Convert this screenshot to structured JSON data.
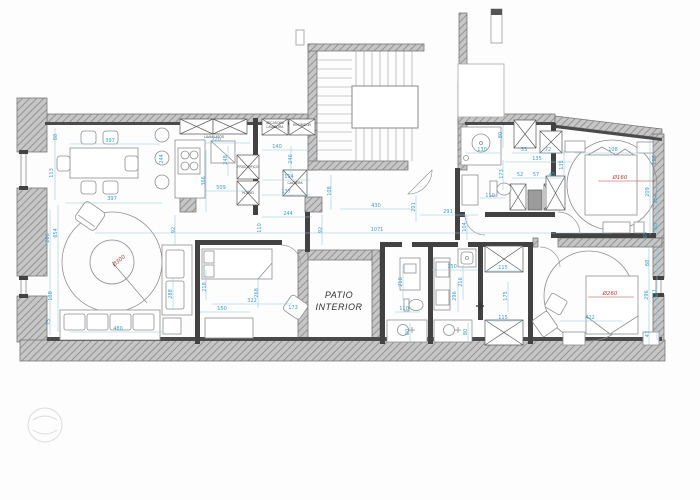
{
  "plan": {
    "labels": {
      "patio_line1": "PATIO",
      "patio_line2": "INTERIOR",
      "lavaplatos": "LAVAPLATOS",
      "secadora": "SECADORA",
      "lavadora": "LAVADORA",
      "recibidor": "RECIBIDOR",
      "frigorifico": "FRIGORIFICO",
      "horno": "HORNO",
      "caldera": "CALDERA"
    },
    "colors": {
      "dimension_blue": "#3e9ec6",
      "diameter_red": "#b2403c",
      "wall_gray": "#c4c4c4",
      "wall_dark": "#424242"
    },
    "diameters": [
      {
        "text": "Ø300",
        "x": 120,
        "y": 262,
        "rot": -40
      },
      {
        "text": "Ø160",
        "x": 620,
        "y": 179,
        "rot": 0
      },
      {
        "text": "Ø260",
        "x": 610,
        "y": 295,
        "rot": 0
      }
    ],
    "dimensions": [
      {
        "text": "88",
        "x": 57,
        "y": 137,
        "rot": -90
      },
      {
        "text": "113",
        "x": 53,
        "y": 173,
        "rot": -90
      },
      {
        "text": "397",
        "x": 110,
        "y": 142,
        "rot": 0
      },
      {
        "text": "244",
        "x": 163,
        "y": 159,
        "rot": -90
      },
      {
        "text": "397",
        "x": 112,
        "y": 200,
        "rot": 0
      },
      {
        "text": "266",
        "x": 49,
        "y": 238,
        "rot": -90
      },
      {
        "text": "654",
        "x": 57,
        "y": 233,
        "rot": -90
      },
      {
        "text": "108",
        "x": 52,
        "y": 296,
        "rot": -90
      },
      {
        "text": "75",
        "x": 50,
        "y": 322,
        "rot": -90
      },
      {
        "text": "480",
        "x": 118,
        "y": 330,
        "rot": 0
      },
      {
        "text": "288",
        "x": 172,
        "y": 294,
        "rot": -90
      },
      {
        "text": "92",
        "x": 175,
        "y": 230,
        "rot": -90
      },
      {
        "text": "220",
        "x": 216,
        "y": 141,
        "rot": 0
      },
      {
        "text": "366",
        "x": 205,
        "y": 181,
        "rot": -90
      },
      {
        "text": "509",
        "x": 221,
        "y": 189,
        "rot": 0
      },
      {
        "text": "248",
        "x": 227,
        "y": 160,
        "rot": -90
      },
      {
        "text": "140",
        "x": 277,
        "y": 148,
        "rot": 0
      },
      {
        "text": "246",
        "x": 292,
        "y": 159,
        "rot": -90
      },
      {
        "text": "154",
        "x": 289,
        "y": 178,
        "rot": 0
      },
      {
        "text": "137",
        "x": 286,
        "y": 193,
        "rot": 0
      },
      {
        "text": "244",
        "x": 288,
        "y": 215,
        "rot": 0
      },
      {
        "text": "110",
        "x": 261,
        "y": 228,
        "rot": -90
      },
      {
        "text": "92",
        "x": 322,
        "y": 230,
        "rot": -90
      },
      {
        "text": "108",
        "x": 331,
        "y": 191,
        "rot": -90
      },
      {
        "text": "430",
        "x": 376,
        "y": 207,
        "rot": 0
      },
      {
        "text": "201",
        "x": 415,
        "y": 207,
        "rot": -90
      },
      {
        "text": "291",
        "x": 448,
        "y": 213,
        "rot": 0
      },
      {
        "text": "104",
        "x": 466,
        "y": 227,
        "rot": -90
      },
      {
        "text": "1071",
        "x": 377,
        "y": 231,
        "rot": 0
      },
      {
        "text": "130",
        "x": 482,
        "y": 151,
        "rot": 0
      },
      {
        "text": "80",
        "x": 502,
        "y": 135,
        "rot": -90
      },
      {
        "text": "53",
        "x": 524,
        "y": 151,
        "rot": 0
      },
      {
        "text": "72",
        "x": 548,
        "y": 151,
        "rot": 0
      },
      {
        "text": "135",
        "x": 537,
        "y": 160,
        "rot": 0
      },
      {
        "text": "173",
        "x": 503,
        "y": 174,
        "rot": -90
      },
      {
        "text": "52",
        "x": 520,
        "y": 176,
        "rot": 0
      },
      {
        "text": "57",
        "x": 536,
        "y": 176,
        "rot": 0
      },
      {
        "text": "45",
        "x": 552,
        "y": 176,
        "rot": 0
      },
      {
        "text": "110",
        "x": 490,
        "y": 197,
        "rot": 0
      },
      {
        "text": "108",
        "x": 613,
        "y": 151,
        "rot": 0
      },
      {
        "text": "135",
        "x": 563,
        "y": 165,
        "rot": -90
      },
      {
        "text": "126",
        "x": 656,
        "y": 160,
        "rot": -90
      },
      {
        "text": "209",
        "x": 649,
        "y": 192,
        "rot": -90
      },
      {
        "text": "117",
        "x": 657,
        "y": 199,
        "rot": -90
      },
      {
        "text": "65",
        "x": 657,
        "y": 226,
        "rot": -90
      },
      {
        "text": "218",
        "x": 206,
        "y": 287,
        "rot": -90
      },
      {
        "text": "268",
        "x": 258,
        "y": 293,
        "rot": -90
      },
      {
        "text": "322",
        "x": 252,
        "y": 302,
        "rot": 0
      },
      {
        "text": "150",
        "x": 222,
        "y": 310,
        "rot": 0
      },
      {
        "text": "173",
        "x": 293,
        "y": 309,
        "rot": 0
      },
      {
        "text": "216",
        "x": 402,
        "y": 282,
        "rot": -90
      },
      {
        "text": "110",
        "x": 404,
        "y": 310,
        "rot": 0
      },
      {
        "text": "150",
        "x": 452,
        "y": 268,
        "rot": 0
      },
      {
        "text": "216",
        "x": 462,
        "y": 282,
        "rot": -90
      },
      {
        "text": "296",
        "x": 456,
        "y": 296,
        "rot": -90
      },
      {
        "text": "175",
        "x": 507,
        "y": 296,
        "rot": -90
      },
      {
        "text": "115",
        "x": 503,
        "y": 269,
        "rot": 0
      },
      {
        "text": "115",
        "x": 503,
        "y": 319,
        "rot": 0
      },
      {
        "text": "80",
        "x": 409,
        "y": 332,
        "rot": -90
      },
      {
        "text": "80",
        "x": 467,
        "y": 332,
        "rot": -90
      },
      {
        "text": "65",
        "x": 647,
        "y": 235,
        "rot": -90
      },
      {
        "text": "88",
        "x": 649,
        "y": 263,
        "rot": -90
      },
      {
        "text": "296",
        "x": 648,
        "y": 295,
        "rot": -90
      },
      {
        "text": "131",
        "x": 656,
        "y": 294,
        "rot": -90
      },
      {
        "text": "47",
        "x": 649,
        "y": 334,
        "rot": -90
      },
      {
        "text": "422",
        "x": 590,
        "y": 319,
        "rot": 0
      }
    ]
  }
}
